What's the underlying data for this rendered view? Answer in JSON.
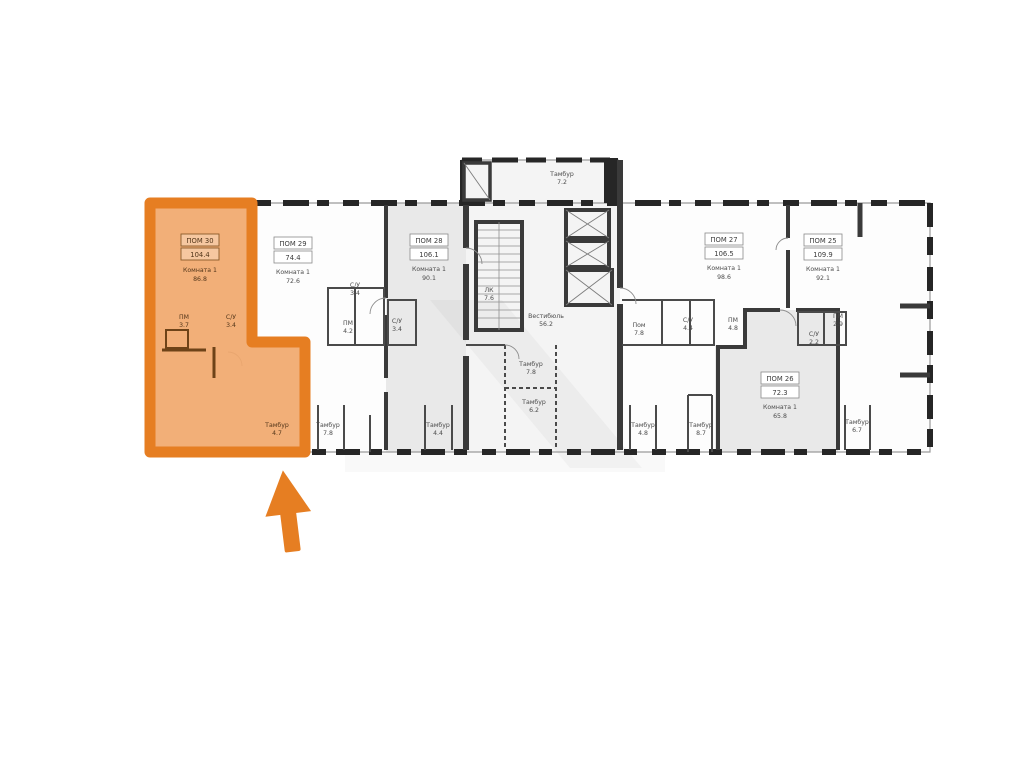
{
  "image": {
    "kind": "apartment floor plan with highlighted unit",
    "background": "#ffffff"
  },
  "plan": {
    "wall_color": "#3a3a3a",
    "gray_unit_fill": "#e9e9e9",
    "core_fill": "#f4f4f4",
    "highlight": {
      "border_color": "#e67e22",
      "fill_color": "#f1a86c"
    },
    "units": [
      {
        "id": "30",
        "number": "ПОМ 30",
        "area": "104.4",
        "highlighted": true,
        "rooms": [
          {
            "name": "Комната 1",
            "area": "86.8"
          },
          {
            "name": "ПМ",
            "area": "3.7"
          },
          {
            "name": "С/У",
            "area": "3.4"
          },
          {
            "name": "Тамбур",
            "area": "4.7"
          }
        ]
      },
      {
        "id": "29",
        "number": "ПОМ 29",
        "area": "74.4",
        "highlighted": false,
        "rooms": [
          {
            "name": "Комната 1",
            "area": "72.6"
          },
          {
            "name": "С/У",
            "area": "3.4"
          },
          {
            "name": "ПМ",
            "area": "4.2"
          },
          {
            "name": "Тамбур",
            "area": "7.8"
          }
        ]
      },
      {
        "id": "28",
        "number": "ПОМ 28",
        "area": "106.1",
        "highlighted": false,
        "rooms": [
          {
            "name": "Комната 1",
            "area": "90.1"
          },
          {
            "name": "С/У",
            "area": "3.4"
          },
          {
            "name": "Тамбур",
            "area": "4.4"
          }
        ]
      },
      {
        "id": "27",
        "number": "ПОМ 27",
        "area": "106.5",
        "highlighted": false,
        "rooms": [
          {
            "name": "Комната 1",
            "area": "98.6"
          },
          {
            "name": "Пом",
            "area": "7.8"
          },
          {
            "name": "С/У",
            "area": "4.4"
          },
          {
            "name": "ПМ",
            "area": "4.8"
          },
          {
            "name": "Тамбур",
            "area": "4.8"
          }
        ]
      },
      {
        "id": "26",
        "number": "ПОМ 26",
        "area": "72.3",
        "highlighted": false,
        "rooms": [
          {
            "name": "Комната 1",
            "area": "65.8"
          },
          {
            "name": "Тамбур",
            "area": "8.7"
          }
        ]
      },
      {
        "id": "25",
        "number": "ПОМ 25",
        "area": "109.9",
        "highlighted": false,
        "rooms": [
          {
            "name": "Комната 1",
            "area": "92.1"
          },
          {
            "name": "ПМ",
            "area": "2.9"
          },
          {
            "name": "С/У",
            "area": "2.2"
          },
          {
            "name": "Тамбур",
            "area": "6.7"
          }
        ]
      }
    ],
    "core": {
      "labels": [
        {
          "name": "Тамбур",
          "area": "7.2"
        },
        {
          "name": "ЛК",
          "area": "7.6"
        },
        {
          "name": "Вестибюль",
          "area": "56.2"
        },
        {
          "name": "Тамбур",
          "area": "7.8"
        },
        {
          "name": "Тамбур",
          "area": "6.2"
        }
      ]
    }
  },
  "pointer": {
    "shape": "arrow-up",
    "color": "#e67e22"
  }
}
